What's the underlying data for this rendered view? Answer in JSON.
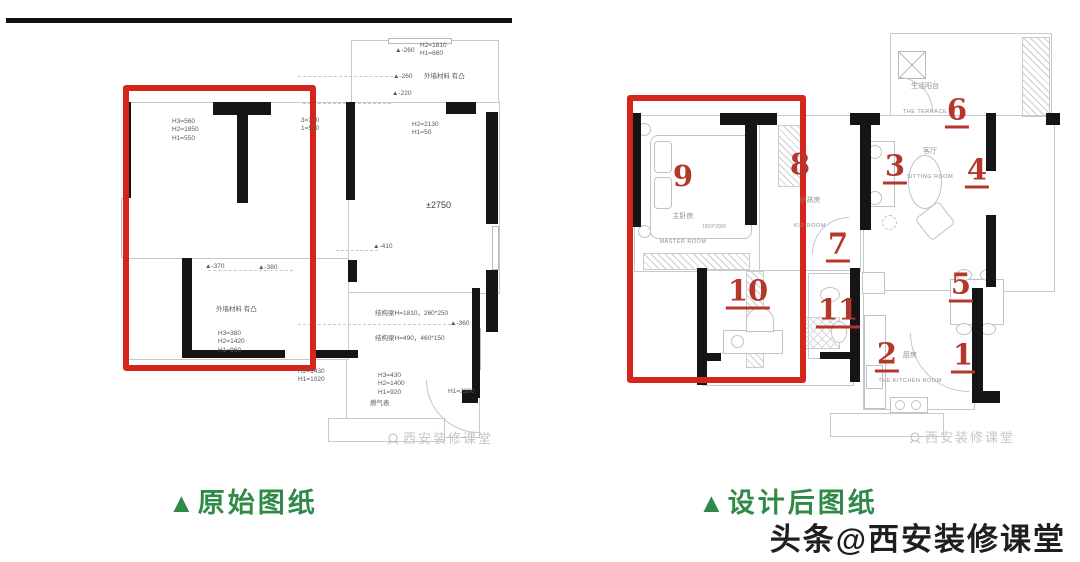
{
  "colors": {
    "highlight_red": "#d6251a",
    "marker_red": "#b5372c",
    "caption_green": "#2f8a47",
    "wall_black": "#151515"
  },
  "plans": {
    "before": {
      "caption": "▲原始图纸",
      "watermark": "西安装修课堂",
      "annotations": [
        "▲-260",
        "H2=1810\nH1=660",
        "▲-260",
        "外墙材料 有凸",
        "▲-220",
        "H3=560\nH2=1850\nH1=550",
        "3=370\n1=540",
        "H2=2130\nH1=50",
        "±2750",
        "▲-410",
        "▲-370",
        "▲-380",
        "外墙材料 有凸",
        "H3=380\nH2=1420\nH1=960",
        "结构梁H=1810，260*250",
        "▲-360",
        "结构梁H=490，460*150",
        "H2=1430\nH1=1020",
        "H3=430\nH2=1400\nH1=920",
        "燃气表",
        "H1=2200"
      ]
    },
    "after": {
      "caption": "▲设计后图纸",
      "watermark": "西安装修课堂",
      "markers": [
        "1",
        "2",
        "3",
        "4",
        "5",
        "6",
        "7",
        "8",
        "9",
        "10",
        "11"
      ],
      "rooms": [
        {
          "cn": "生活阳台",
          "en": "THE TERRACE"
        },
        {
          "cn": "客厅",
          "en": "SITTING ROOM"
        },
        {
          "cn": "小孩房",
          "en": "KID ROOM"
        },
        {
          "cn": "主卧房",
          "en": "MASTER ROOM"
        },
        {
          "cn": "厨房",
          "en": "THE KITCHEN ROOM"
        }
      ],
      "bed_size": "1800*2000"
    }
  },
  "footer": {
    "byline": "头条@西安装修课堂"
  }
}
